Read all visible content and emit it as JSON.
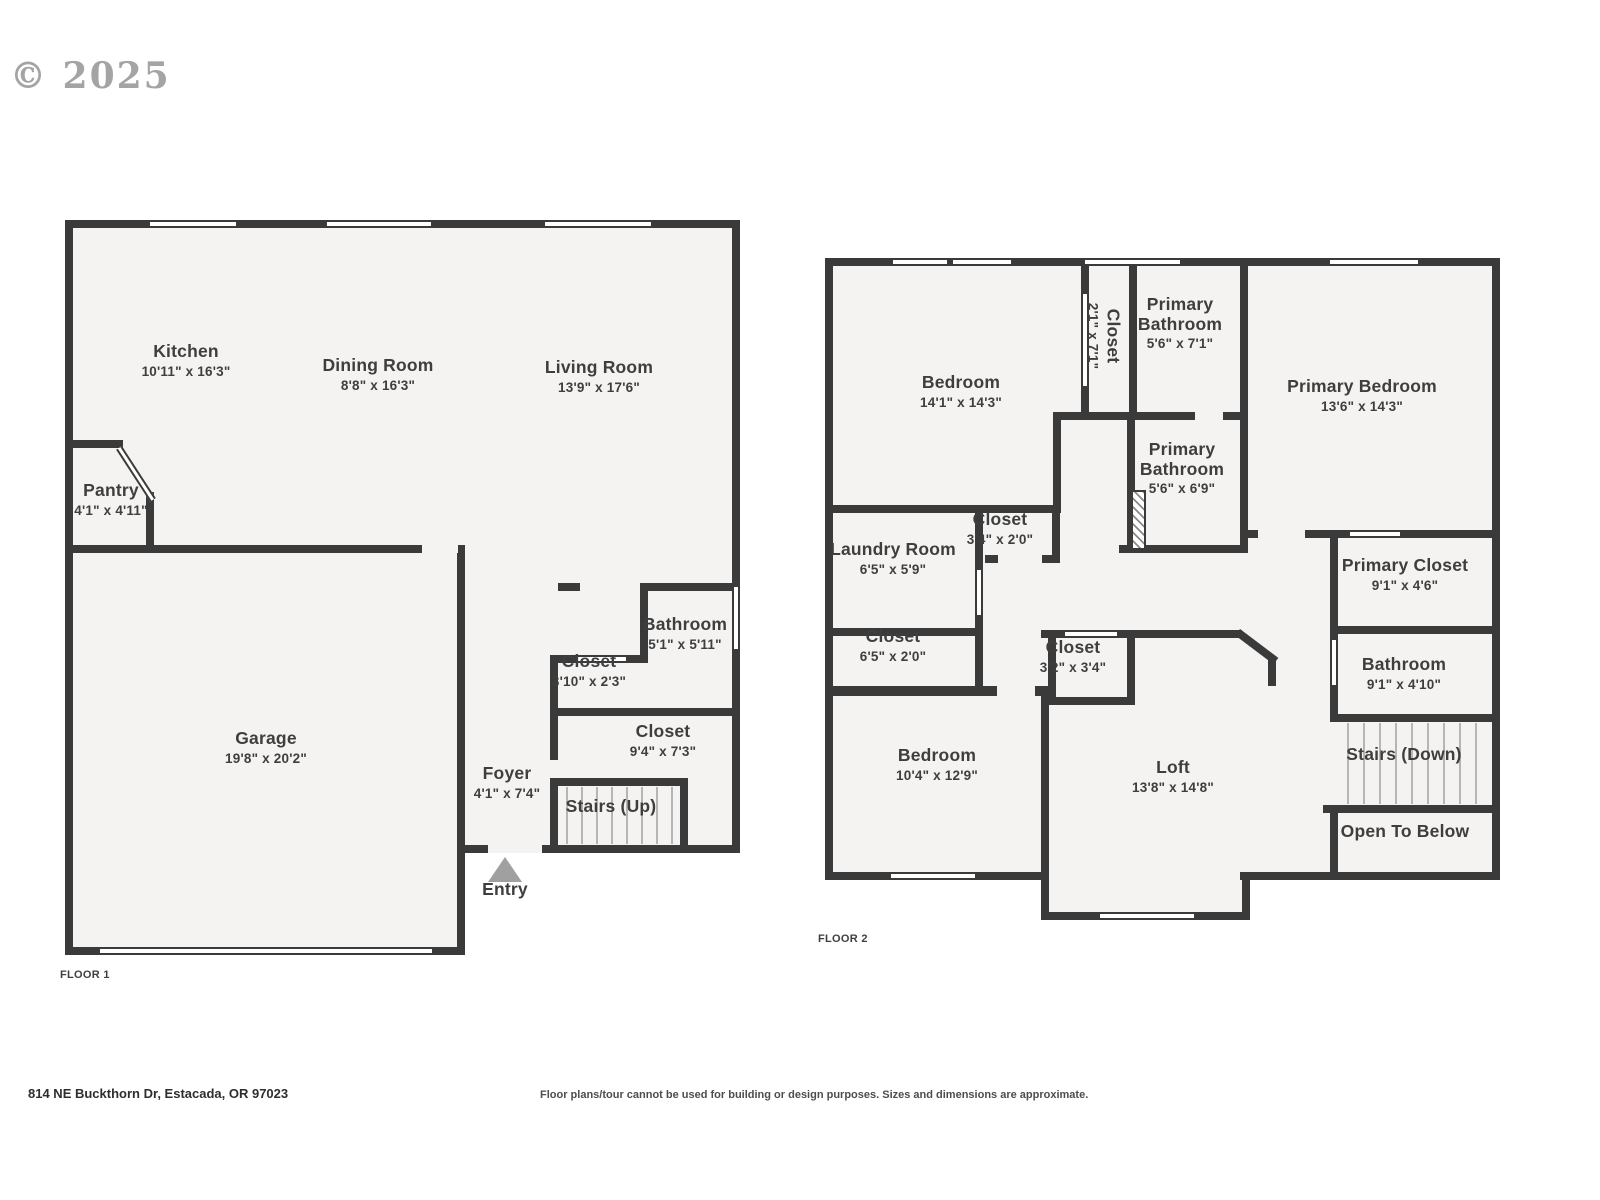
{
  "watermark": "© 2025",
  "floor1": {
    "label": "FLOOR 1",
    "rooms": {
      "kitchen": {
        "name": "Kitchen",
        "dims": "10'11\" x 16'3\""
      },
      "dining": {
        "name": "Dining Room",
        "dims": "8'8\" x 16'3\""
      },
      "living": {
        "name": "Living Room",
        "dims": "13'9\" x 17'6\""
      },
      "pantry": {
        "name": "Pantry",
        "dims": "4'1\" x 4'11\""
      },
      "garage": {
        "name": "Garage",
        "dims": "19'8\" x 20'2\""
      },
      "bathroom": {
        "name": "Bathroom",
        "dims": "5'1\" x 5'11\""
      },
      "closet_hall": {
        "name": "Closet",
        "dims": "3'10\" x 2'3\""
      },
      "closet_stairs": {
        "name": "Closet",
        "dims": "9'4\" x 7'3\""
      },
      "foyer": {
        "name": "Foyer",
        "dims": "4'1\" x 7'4\""
      },
      "stairs_up": {
        "name": "Stairs (Up)"
      },
      "entry": {
        "name": "Entry"
      }
    }
  },
  "floor2": {
    "label": "FLOOR 2",
    "rooms": {
      "bedroom1": {
        "name": "Bedroom",
        "dims": "14'1\" x 14'3\""
      },
      "closet_tall": {
        "name": "Closet",
        "dims": "2'1\" x 7'1\""
      },
      "primary_bath1": {
        "name": "Primary Bathroom",
        "dims": "5'6\" x 7'1\""
      },
      "primary_bedroom": {
        "name": "Primary Bedroom",
        "dims": "13'6\" x 14'3\""
      },
      "primary_bath2": {
        "name": "Primary Bathroom",
        "dims": "5'6\" x 6'9\""
      },
      "laundry": {
        "name": "Laundry Room",
        "dims": "6'5\" x 5'9\""
      },
      "closet_laundry": {
        "name": "Closet",
        "dims": "3'4\" x 2'0\""
      },
      "closet_hall": {
        "name": "Closet",
        "dims": "6'5\" x 2'0\""
      },
      "closet_loft": {
        "name": "Closet",
        "dims": "3'2\" x 3'4\""
      },
      "bedroom2": {
        "name": "Bedroom",
        "dims": "10'4\" x 12'9\""
      },
      "loft": {
        "name": "Loft",
        "dims": "13'8\" x 14'8\""
      },
      "primary_closet": {
        "name": "Primary Closet",
        "dims": "9'1\" x 4'6\""
      },
      "bathroom": {
        "name": "Bathroom",
        "dims": "9'1\" x 4'10\""
      },
      "stairs_down": {
        "name": "Stairs (Down)"
      },
      "open_below": {
        "name": "Open To Below"
      }
    }
  },
  "footer": {
    "address": "814 NE Buckthorn Dr, Estacada, OR 97023",
    "disclaimer": "Floor plans/tour cannot be used for building or design purposes. Sizes and dimensions are approximate."
  }
}
